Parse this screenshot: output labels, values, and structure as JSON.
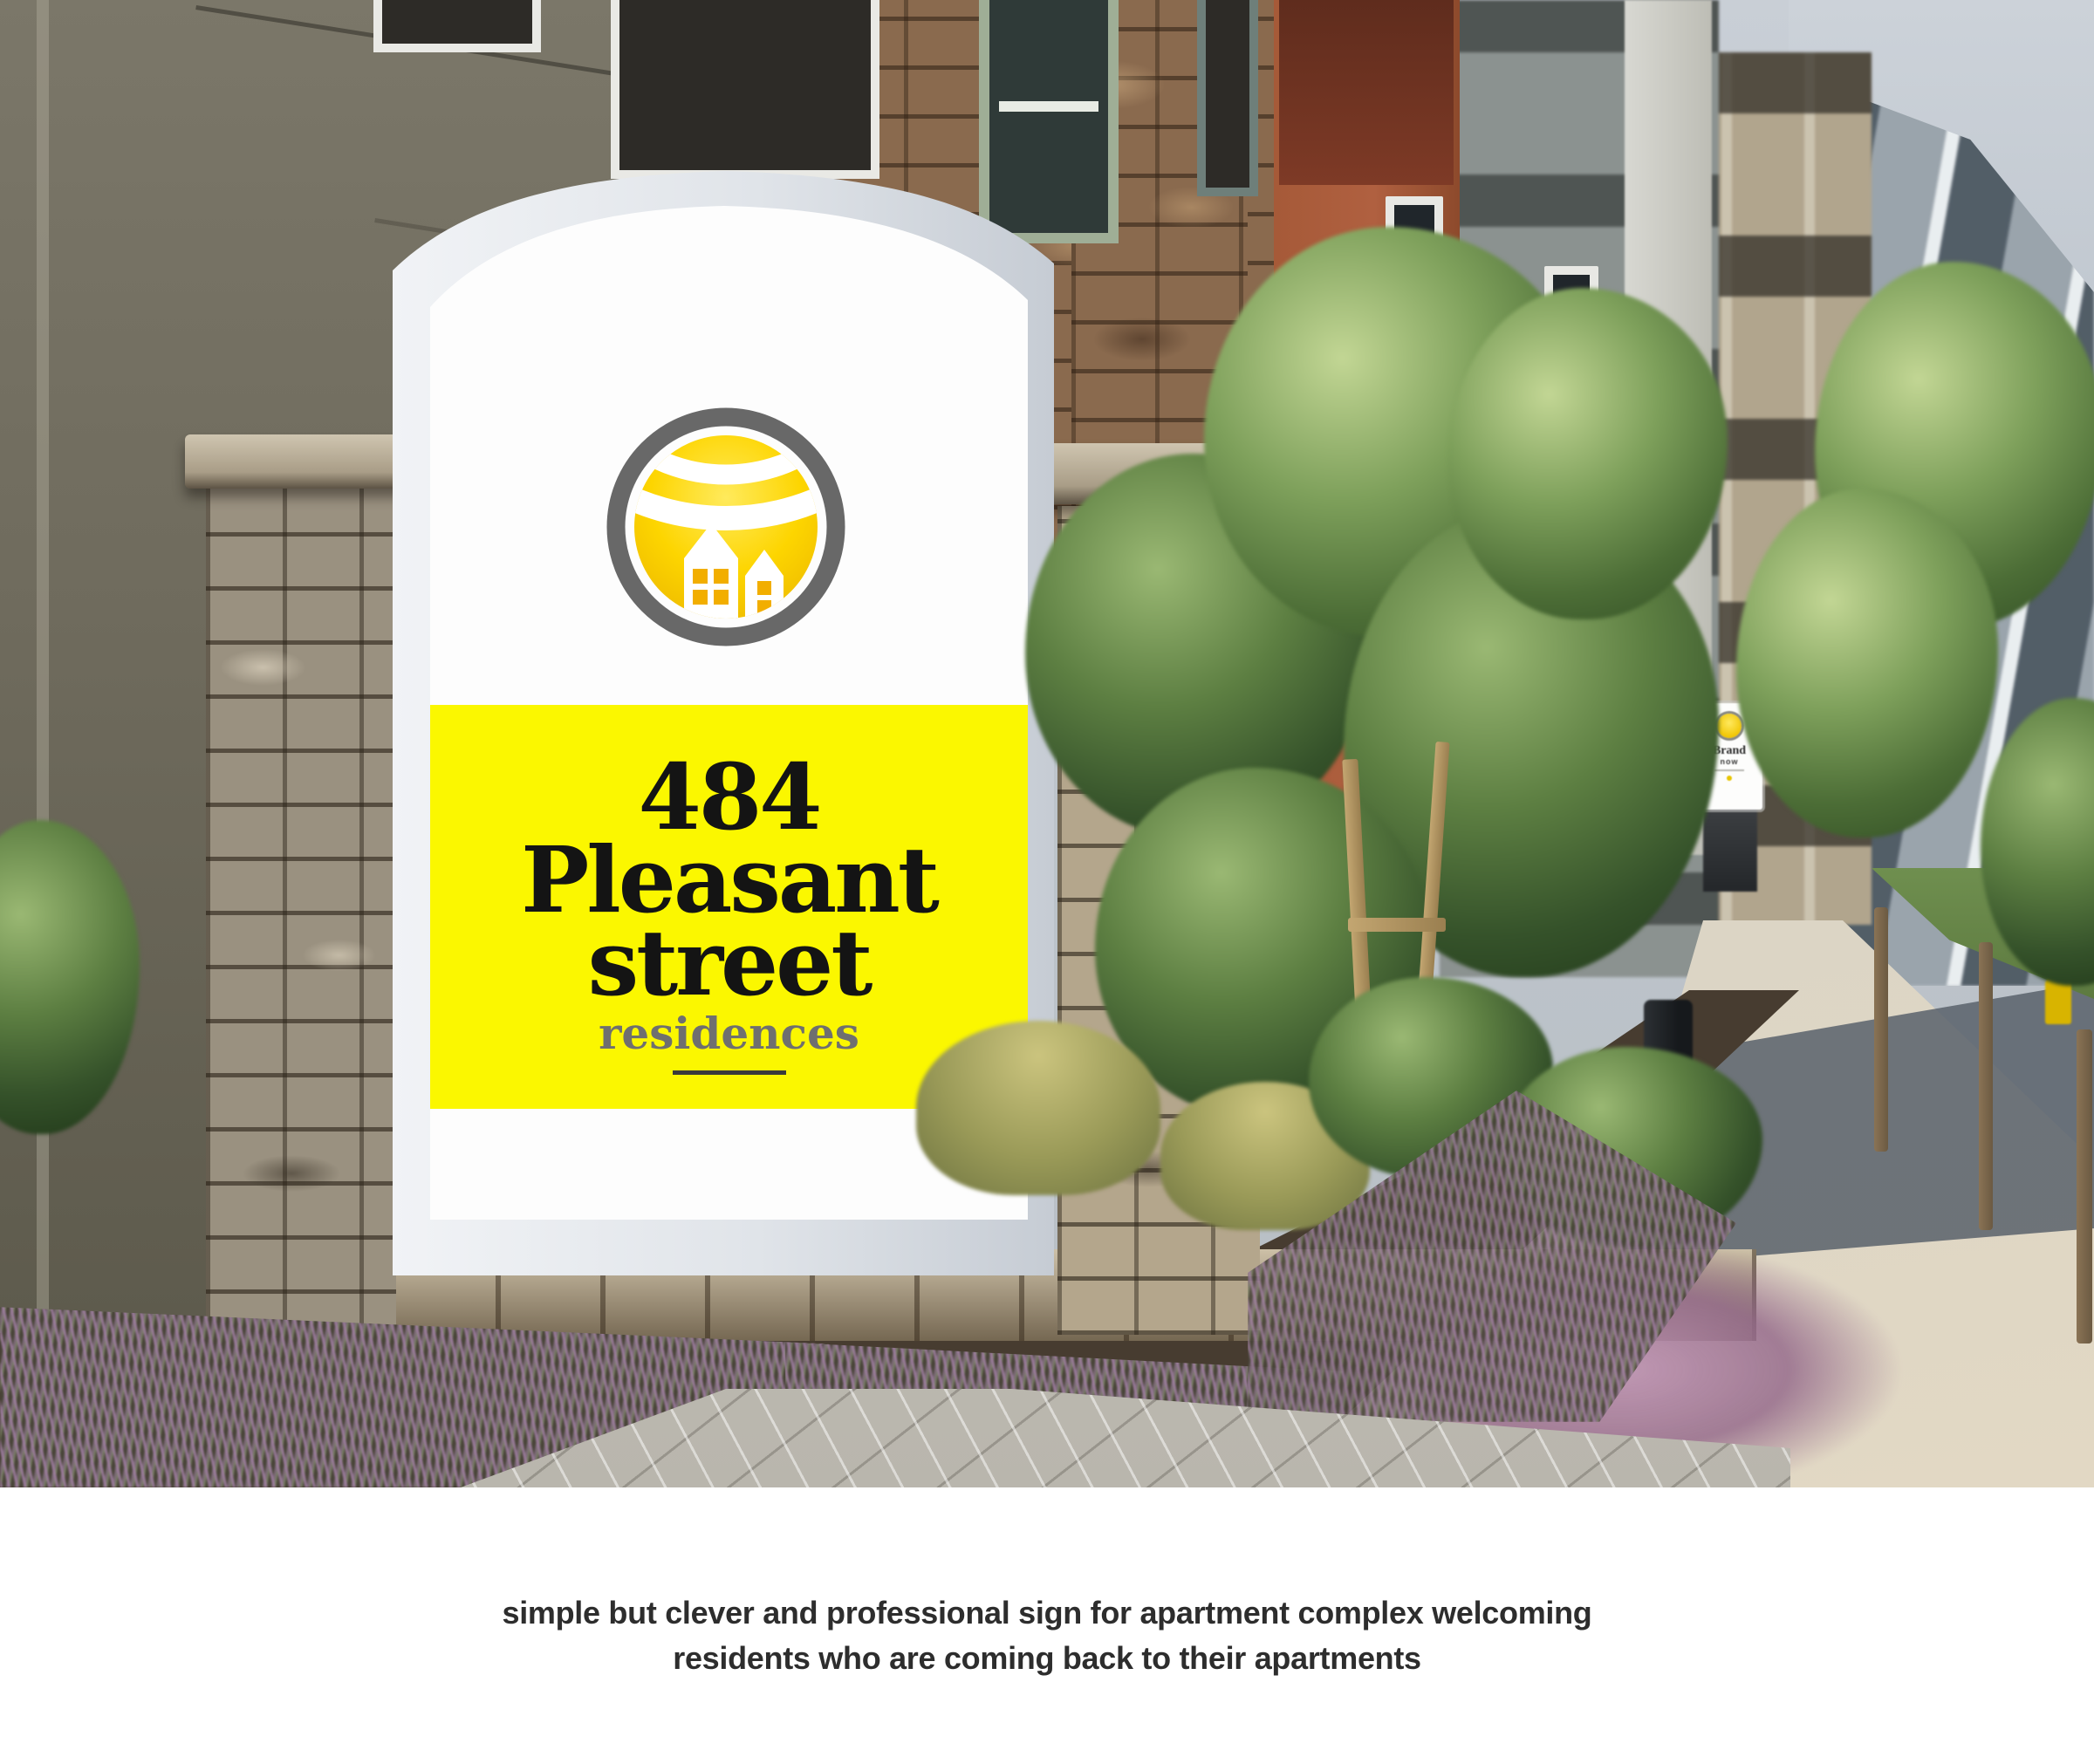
{
  "monument_sign": {
    "address_number": "484",
    "address_street": "Pleasant",
    "address_street2": "street",
    "descriptor": "residences",
    "panel_color": "#FBF700",
    "address_color": "#141414",
    "descriptor_color": "#6F6F6F",
    "frame_color": "#E4E8ED",
    "face_color": "#FDFDFD"
  },
  "logo": {
    "icon": "sun-over-houses-logo-icon",
    "ring_color": "#686868",
    "sun_color_top": "#FFEA5C",
    "sun_color_bottom": "#EDB900",
    "house_color": "#FFFFFF",
    "window_color": "#F2AE00"
  },
  "distant_sign": {
    "line1": "Brand",
    "line2": "now"
  },
  "caption": {
    "line1": "simple but clever and professional sign for apartment complex welcoming",
    "line2": "residents who are coming back to their apartments",
    "text_color": "#2D2D2D",
    "background": "#FFFFFF"
  }
}
